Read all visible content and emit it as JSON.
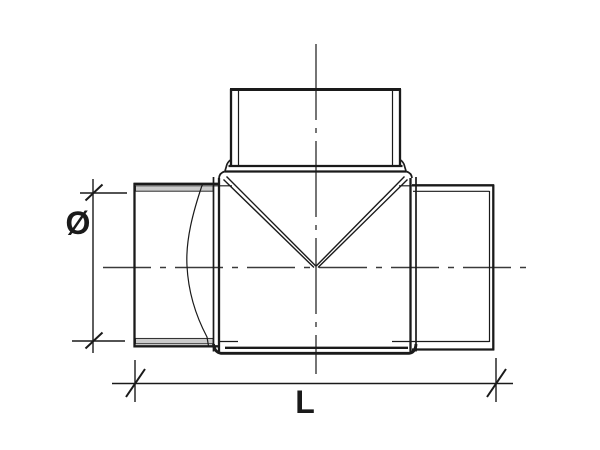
{
  "drawing": {
    "labels": {
      "diameter": "Ø",
      "length": "L"
    },
    "colors": {
      "line": "#1a1a1a",
      "centerline": "#3a3a3a",
      "gasket_fill": "#cbcbcb",
      "background": "#ffffff"
    }
  }
}
